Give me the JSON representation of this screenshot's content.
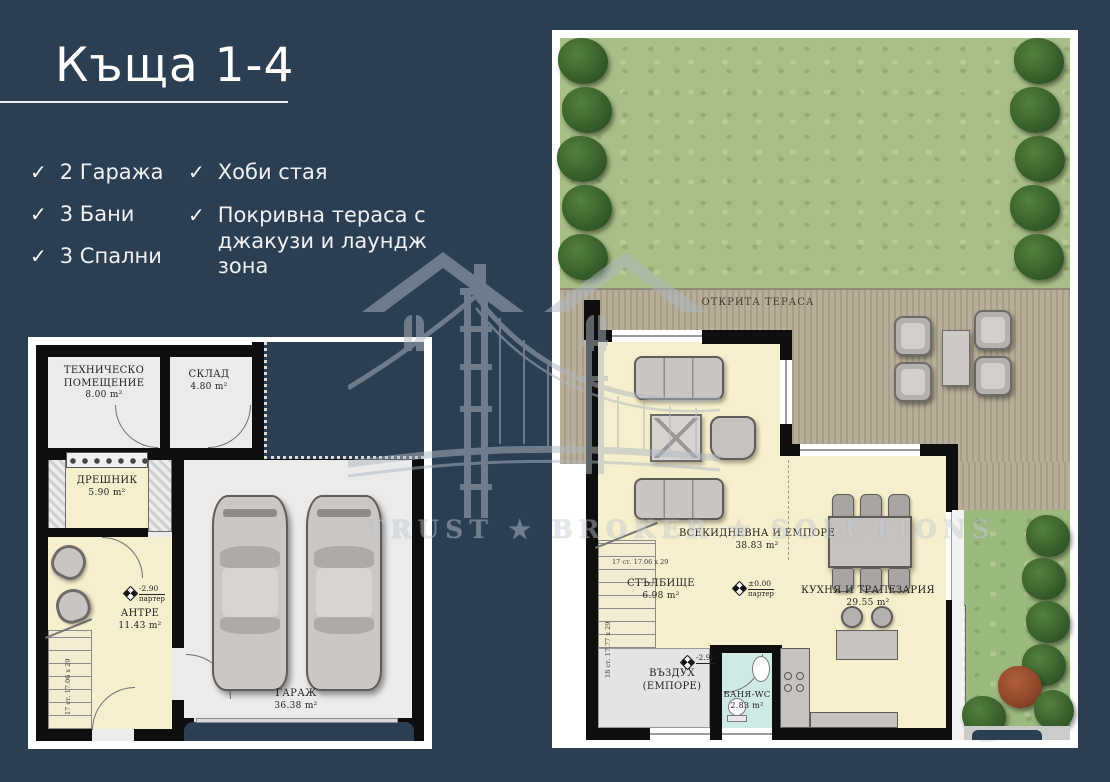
{
  "header": {
    "title": "Къща 1-4"
  },
  "features": {
    "garages": "2 Гаража",
    "baths": "3 Бани",
    "bedrooms": "3 Спални",
    "hobby_room": "Хоби стая",
    "roof_terrace": "Покривна тераса с джакузи и лаундж зона"
  },
  "watermark": {
    "brand": "TRUST ★ BROKER ★ SOLUTIONS"
  },
  "colors": {
    "background": "#2c3e52",
    "floor_cream": "#f6efcd",
    "floor_gray": "#ebebeb",
    "deck": "#b2aa95",
    "lawn": "#a7bf86",
    "bath": "#cfe9e5"
  },
  "plan_basement": {
    "tech": {
      "name": "ТЕХНИЧЕСКО ПОМЕЩЕНИЕ",
      "area": "8.00 m²"
    },
    "storage": {
      "name": "СКЛАД",
      "area": "4.80 m²"
    },
    "wardrobe": {
      "name": "ДРЕШНИК",
      "area": "5.90 m²"
    },
    "entry": {
      "name": "АНТРЕ",
      "area": "11.43 m²"
    },
    "garage": {
      "name": "ГАРАЖ",
      "area": "36.38 m²"
    },
    "level": {
      "elevation": "-2.90",
      "floor": "партер"
    },
    "stairs": {
      "label": "17 ст. 17.06 х 29"
    }
  },
  "plan_ground": {
    "terrace": {
      "name": "ОТКРИТА ТЕРАСА"
    },
    "living": {
      "name": "ВСЕКИДНЕВНА И ЕМПОРЕ",
      "area": "38.83 m²"
    },
    "staircase": {
      "name": "СТЪЛБИЩЕ",
      "area": "6.98 m²"
    },
    "kitchen": {
      "name": "КУХНЯ И ТРАПЕЗАРИЯ",
      "area": "29.55 m²"
    },
    "void": {
      "name": "ВЪЗДУХ",
      "name2": "(ЕМПОРЕ)",
      "elevation": "-2.90"
    },
    "bath": {
      "name": "БАНЯ-WC",
      "area": "2.83 m²"
    },
    "level": {
      "elevation": "±0.00",
      "floor": "партер"
    },
    "stairs_a": {
      "label": "17 ст. 17.06 х 29"
    },
    "stairs_b": {
      "label": "18 ст. 17.77 х 29"
    }
  }
}
